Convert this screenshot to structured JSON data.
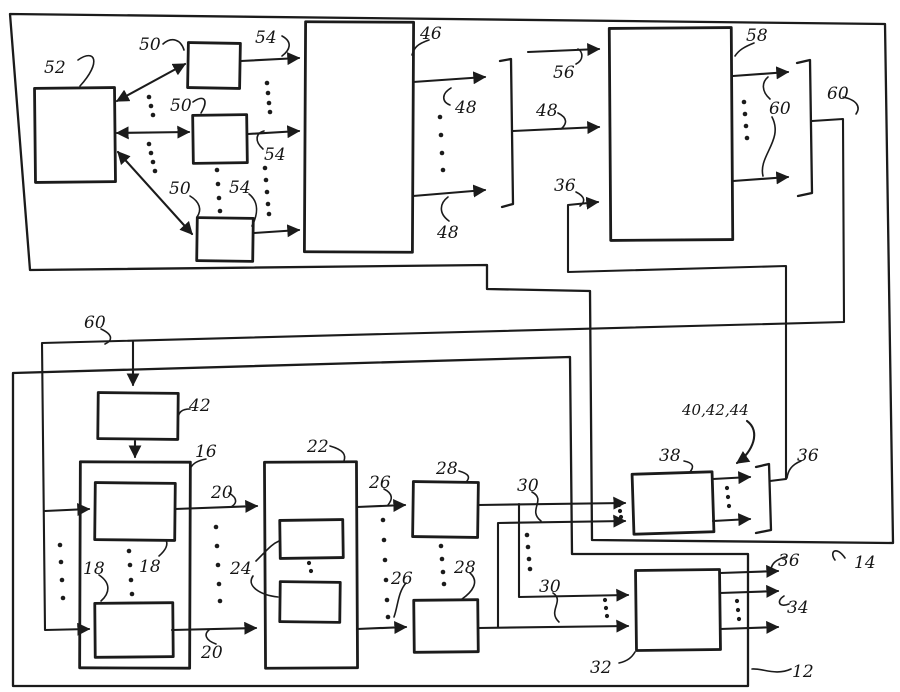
{
  "figure": {
    "background": "#ffffff",
    "ink": "#1b1b1b",
    "labels": {
      "n52": "52",
      "n50a": "50",
      "n50b": "50",
      "n50c": "50",
      "n54a": "54",
      "n54b": "54",
      "n54c": "54",
      "n46": "46",
      "n48a": "48",
      "n48b": "48",
      "n48c": "48",
      "n56": "56",
      "n58": "58",
      "n60a": "60",
      "n60b": "60",
      "n60c": "60",
      "n36a": "36",
      "n36b": "36",
      "n36c": "36",
      "n42": "42",
      "n16": "16",
      "n18a": "18",
      "n18b": "18",
      "n20a": "20",
      "n20b": "20",
      "n22": "22",
      "n24": "24",
      "n26a": "26",
      "n26b": "26",
      "n28a": "28",
      "n28b": "28",
      "n30a": "30",
      "n30b": "30",
      "n38": "38",
      "n404244": "40,42,44",
      "n14": "14",
      "n32": "32",
      "n34": "34",
      "n12": "12"
    }
  }
}
